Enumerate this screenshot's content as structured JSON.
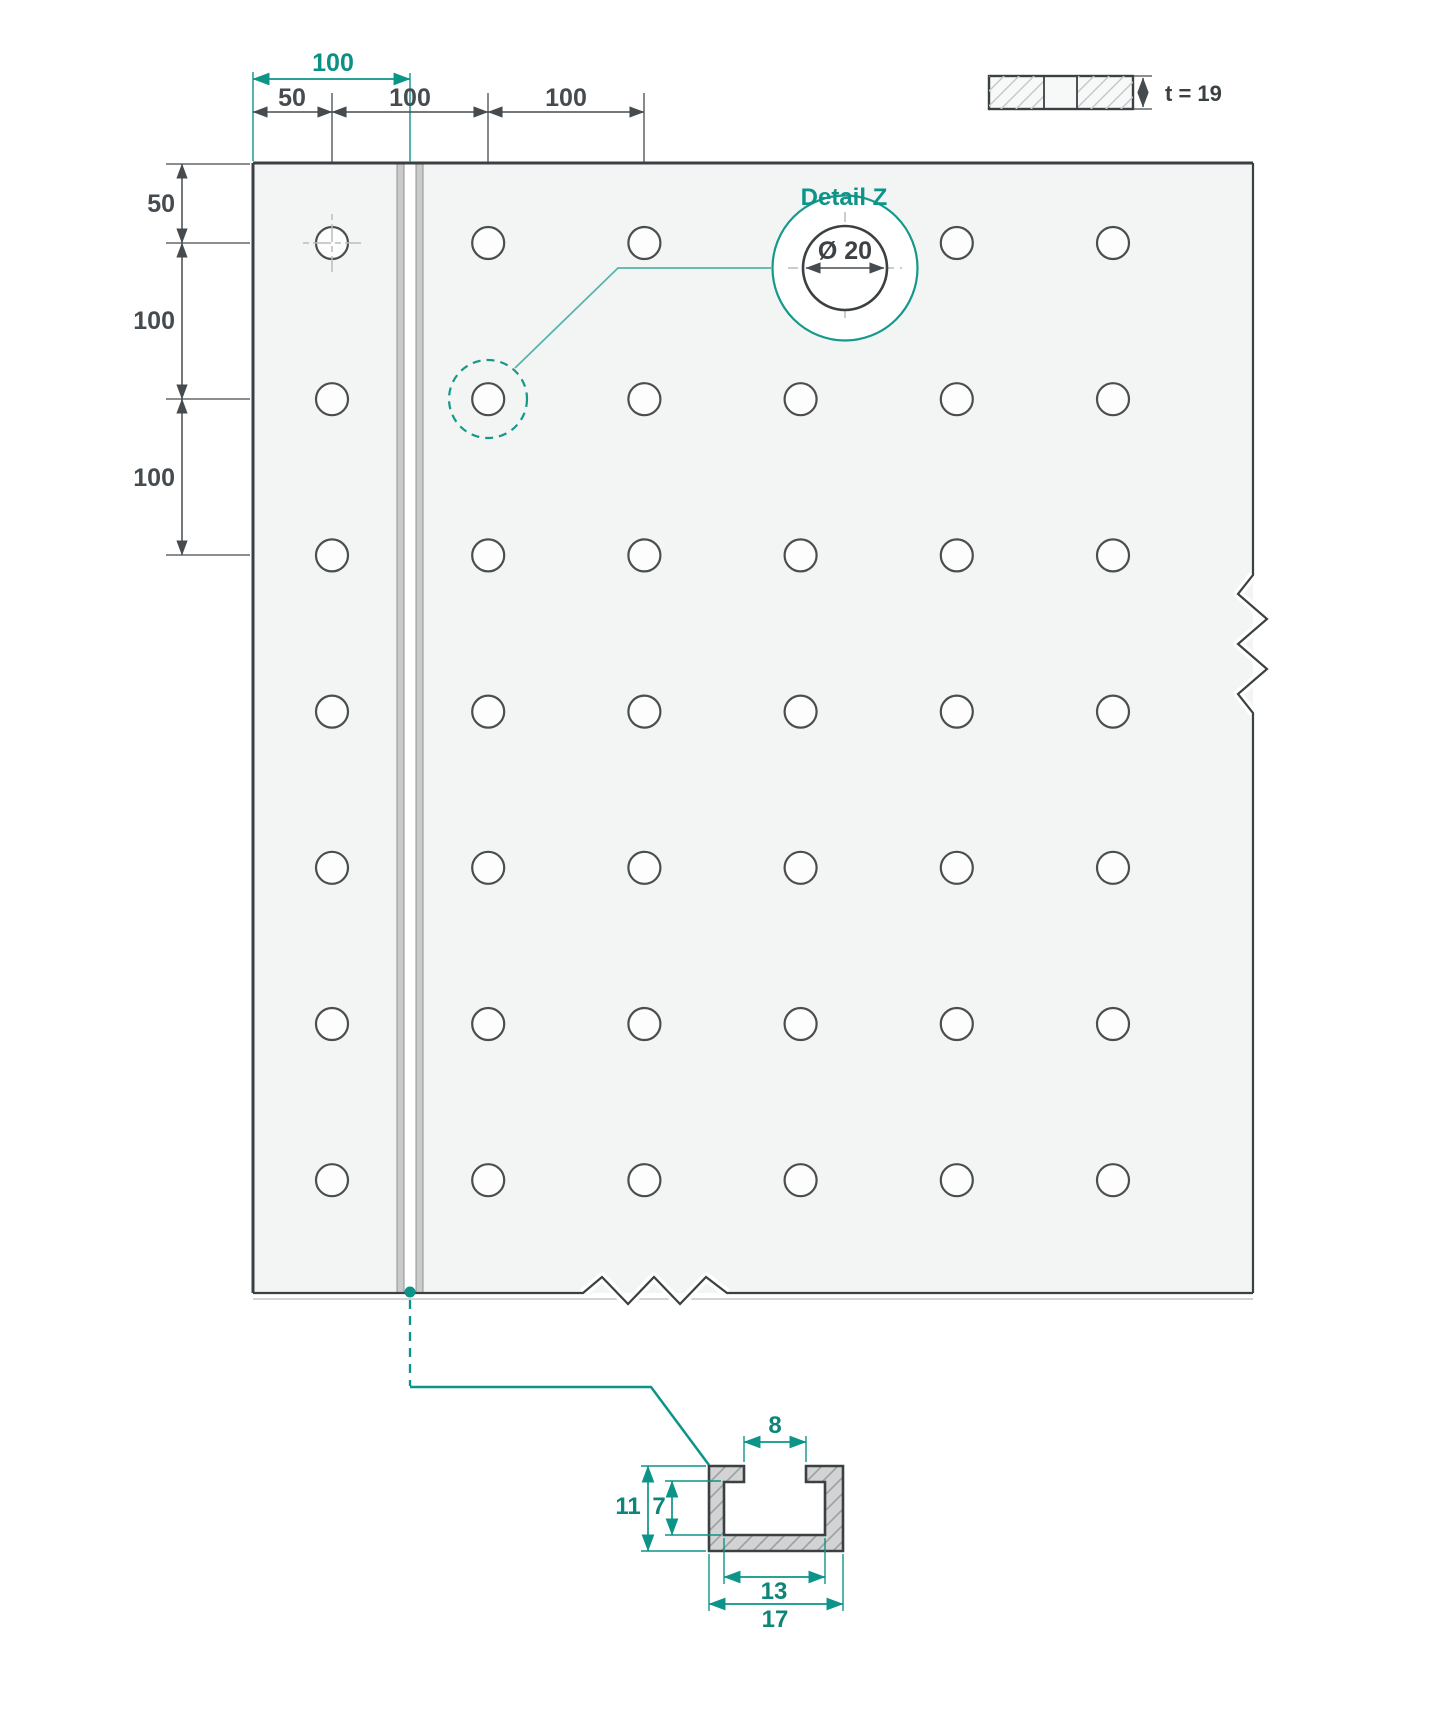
{
  "drawing": {
    "type": "technical-drawing",
    "accent_color": "#0d9488",
    "line_color": "#3b4043"
  },
  "dims": {
    "top_overall": "100",
    "top": [
      "50",
      "100",
      "100"
    ],
    "left": [
      "50",
      "100",
      "100"
    ]
  },
  "detail": {
    "title": "Detail Z",
    "diameter": "Ø 20"
  },
  "thickness": {
    "label": "t = 19"
  },
  "section": {
    "opening_width": "8",
    "total_height": "11",
    "cavity_height": "7",
    "cavity_width": "13",
    "outer_width": "17"
  },
  "plate": {
    "hole_cols": 6,
    "hole_rows": 7
  }
}
